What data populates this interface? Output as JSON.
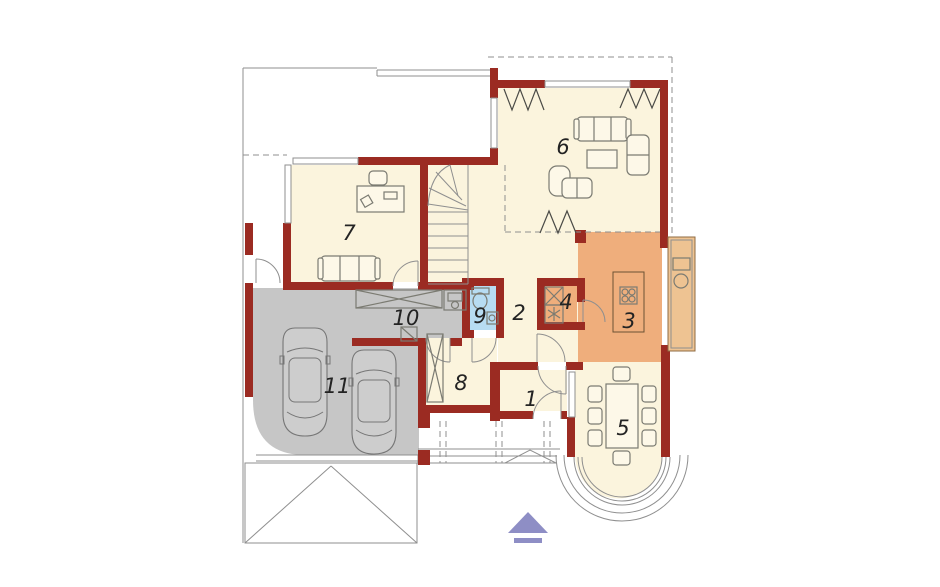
{
  "rooms": [
    {
      "number": "1"
    },
    {
      "number": "2"
    },
    {
      "number": "3"
    },
    {
      "number": "4"
    },
    {
      "number": "5"
    },
    {
      "number": "6"
    },
    {
      "number": "7"
    },
    {
      "number": "8"
    },
    {
      "number": "9"
    },
    {
      "number": "10"
    },
    {
      "number": "11"
    }
  ],
  "colors": {
    "wall": "#9b2b22",
    "floor_cream": "#fbf4dd",
    "kitchen_orange": "#efae7c",
    "garage_gray": "#c6c6c6",
    "bathroom_blue": "#b7dcf2",
    "counter_tan": "#eec392",
    "marker_purple": "#8e8ec5",
    "outline_gray": "#8f8f8f",
    "furniture_gray": "#7b7b72",
    "label_black": "#232323",
    "background": "#ffffff"
  },
  "symbols": {
    "entrance_marker": "triangle-up-with-bar",
    "fridge": "square-with-x",
    "freezer": "square-with-snowflake",
    "cooktop": "four-burners",
    "wardrobe": "rect-with-x",
    "workbench": "rect-with-x"
  }
}
